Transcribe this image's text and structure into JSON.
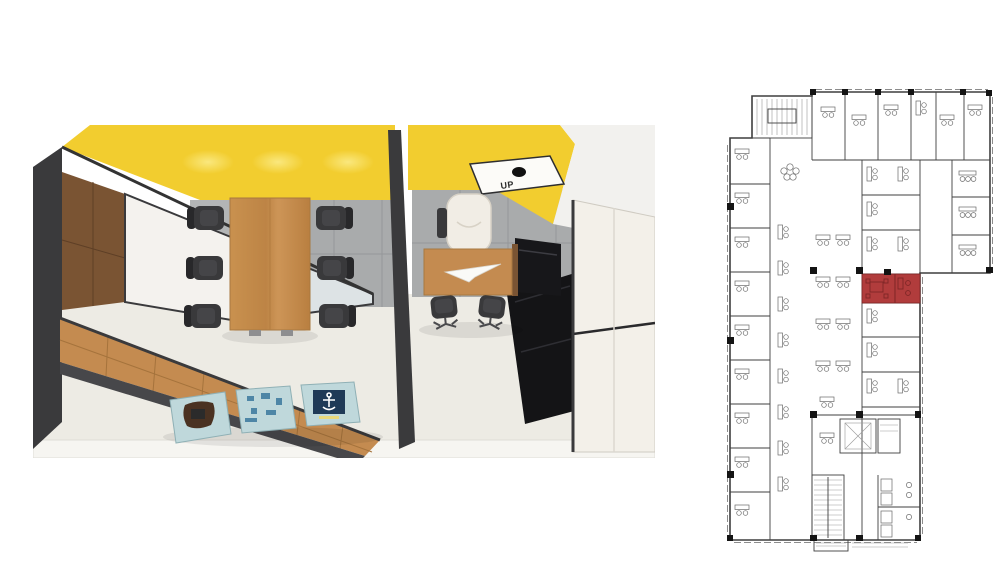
{
  "title": "Office interior 3D render with floor plan location highlight",
  "render": {
    "description": "top-down cutaway render of a meeting room and private office",
    "ceiling_sign_label": "UP",
    "ceiling_light_count": 3,
    "meeting_chair_count": 6,
    "floor_poster_count": 3
  },
  "floorplan": {
    "description": "architectural office floor plan",
    "highlighted_room_count": 2
  },
  "colors": {
    "page-bg": "#ffffff",
    "ceiling-yellow": "#f2cd2f",
    "ceiling-yellow-light": "#fae87e",
    "wood": "#c48b50",
    "wood-dark": "#7a5433",
    "frame-dark": "#3a3a3c",
    "tile-wall": "#a9abac",
    "tile-grout": "#95979a",
    "floor": "#edebe4",
    "chair-dark": "#39393b",
    "poster-bg": "#bfd8db",
    "poster-navy": "#1f3a57",
    "poster-brown": "#4a3222",
    "plan-line": "#3f3f3f",
    "plan-line-light": "#9a9a9a",
    "highlight-red": "#b13c3c",
    "highlight-red-dark": "#7e2626"
  }
}
